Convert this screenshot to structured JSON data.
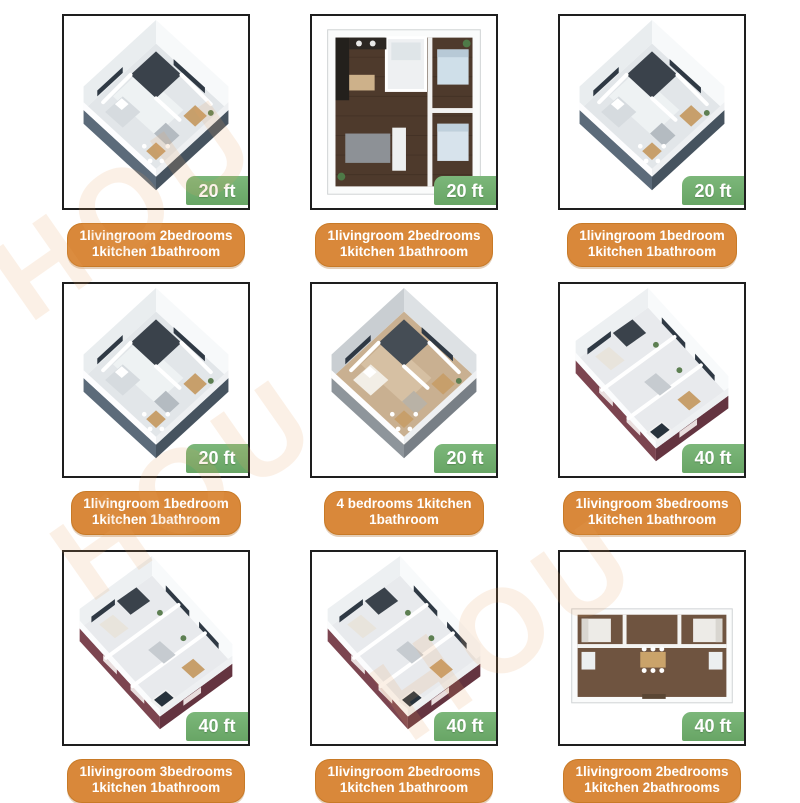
{
  "page": {
    "background": "#ffffff",
    "watermark": {
      "text": "HOU",
      "color": "#eba35f",
      "opacity": 0.15
    }
  },
  "styles": {
    "badge_green": "#6fae6c",
    "caption_orange": "#d9883a",
    "caption_border": "#c87a27",
    "box_border": "#1e1e1e",
    "label_text": "#ffffff"
  },
  "thumb_palettes": {
    "iso-square-white": {
      "skirtL": "#5c6b7a",
      "skirtR": "#46535f",
      "floor": "#e2e6e9",
      "room": "#f0f3f4",
      "wallL": "#e9edef",
      "wallR": "#f7f9fa",
      "window": "#2f3944",
      "dark": "#3a424b",
      "bed": "#d6dbdf",
      "sofa": "#b4bbc1",
      "table": "#c79f6b",
      "plant": "#5d7f52"
    },
    "iso-square-gray": {
      "skirtL": "#8e959b",
      "skirtR": "#787f86",
      "floor": "#c9b091",
      "room": "#d8c3a6",
      "wallL": "#c9ced2",
      "wallR": "#dde1e4",
      "window": "#2f3944",
      "dark": "#454d55",
      "bed": "#f2eee6",
      "sofa": "#b9b2a6",
      "table": "#c79f6b",
      "plant": "#5d7f52"
    },
    "iso-long-maroon": {
      "skirtL": "#7c4550",
      "skirtR": "#643440",
      "floor": "#e8eaed",
      "room": "#f3f5f6",
      "wallL": "#edf0f2",
      "wallR": "#f8fafb",
      "window": "#2f3944",
      "dark": "#3a424b",
      "bed": "#e8e4dc",
      "sofa": "#c6cbd0",
      "table": "#c79f6b",
      "plant": "#5d7f52",
      "glass": "#27323c",
      "skirtWindow": "#e9dede"
    },
    "top-square-wood": {
      "wood": "#4e3a2c",
      "grain": "#3b2c21",
      "wall": "#f2f2f1",
      "tile": "#eef0f2",
      "counter": "#23201c",
      "bed": "#cfdfe9",
      "bed2": "#d7e3ec",
      "rug": "#8d9196",
      "sofa": "#eef0f0",
      "table": "#cdb18a",
      "plant": "#4e7a47"
    },
    "top-wide-brown": {
      "brown": "#6f5440",
      "wall": "#f4f4f2",
      "bed": "#edebe7",
      "fixture": "#eceff0",
      "table": "#caa36a",
      "door": "#5a4634",
      "frame": "#fafbfb",
      "frameEdge": "#cfd2d4"
    }
  },
  "cards": [
    {
      "size_label": "20 ft",
      "caption_lines": [
        "1livingroom 2bedrooms",
        "1kitchen 1bathroom"
      ],
      "thumb": "iso-square-white"
    },
    {
      "size_label": "20 ft",
      "caption_lines": [
        "1livingroom 2bedrooms",
        "1kitchen 1bathroom"
      ],
      "thumb": "top-square-wood"
    },
    {
      "size_label": "20 ft",
      "caption_lines": [
        "1livingroom 1bedroom",
        "1kitchen 1bathroom"
      ],
      "thumb": "iso-square-white"
    },
    {
      "size_label": "20 ft",
      "caption_lines": [
        "1livingroom 1bedroom",
        "1kitchen 1bathroom"
      ],
      "thumb": "iso-square-white"
    },
    {
      "size_label": "20 ft",
      "caption_lines": [
        "4 bedrooms 1kitchen",
        "1bathroom"
      ],
      "thumb": "iso-square-gray"
    },
    {
      "size_label": "40 ft",
      "caption_lines": [
        "1livingroom 3bedrooms",
        "1kitchen 1bathroom"
      ],
      "thumb": "iso-long-maroon"
    },
    {
      "size_label": "40 ft",
      "caption_lines": [
        "1livingroom 3bedrooms",
        "1kitchen 1bathroom"
      ],
      "thumb": "iso-long-maroon"
    },
    {
      "size_label": "40 ft",
      "caption_lines": [
        "1livingroom 2bedrooms",
        "1kitchen 1bathroom"
      ],
      "thumb": "iso-long-maroon"
    },
    {
      "size_label": "40 ft",
      "caption_lines": [
        "1livingroom 2bedrooms",
        "1kitchen 2bathrooms"
      ],
      "thumb": "top-wide-brown"
    }
  ]
}
